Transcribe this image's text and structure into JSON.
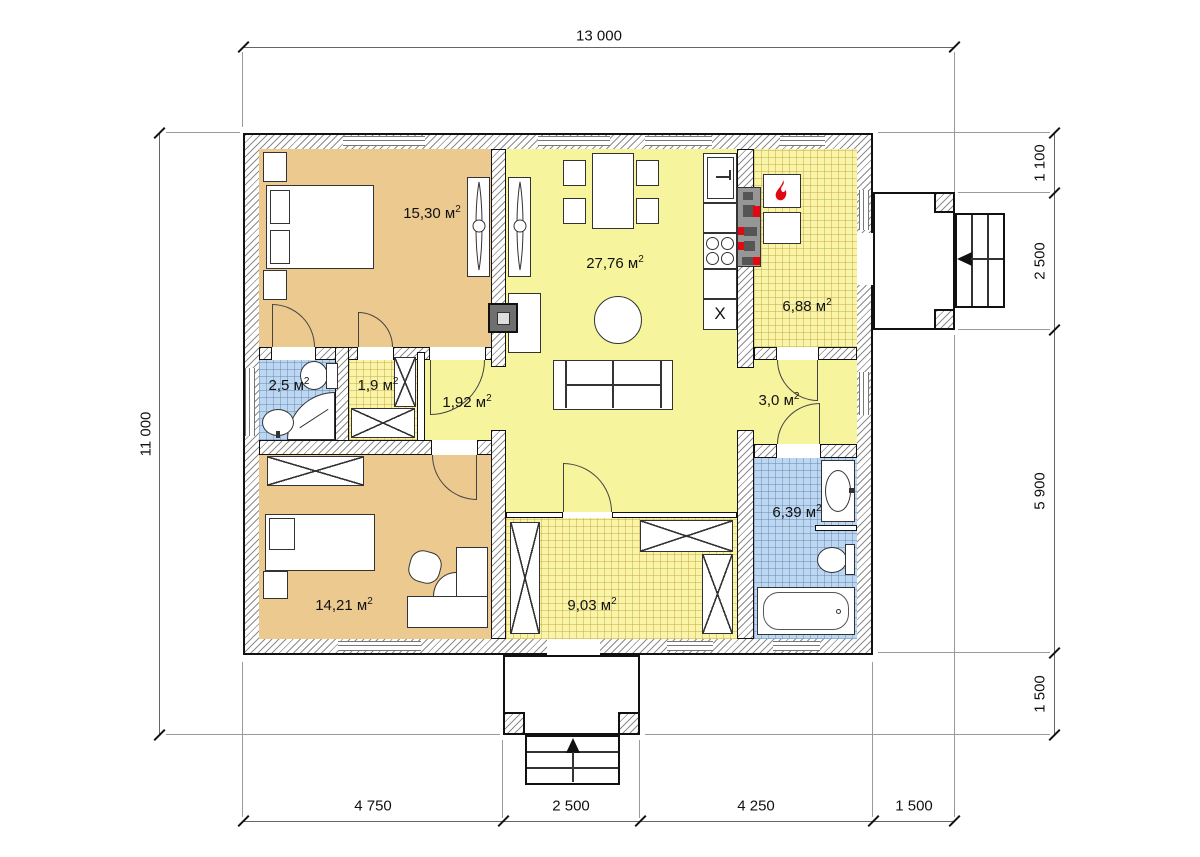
{
  "dimensions": {
    "top": "13 000",
    "left": "11 000",
    "right": [
      "1 100",
      "2 500",
      "5 900",
      "1 500"
    ],
    "bottom": [
      "4 750",
      "2 500",
      "4 250",
      "1 500"
    ]
  },
  "sup2": "2",
  "rooms": {
    "bedroom1": {
      "label": "15,30 м"
    },
    "living": {
      "label": "27,76 м"
    },
    "boiler": {
      "label": "6,88 м"
    },
    "bath_small": {
      "label": "2,5 м"
    },
    "closet": {
      "label": "1,9 м"
    },
    "hall_small": {
      "label": "1,92 м"
    },
    "hall_right": {
      "label": "3,0 м"
    },
    "bedroom2": {
      "label": "14,21 м"
    },
    "hall_entry": {
      "label": "9,03 м"
    },
    "bath_large": {
      "label": "6,39 м"
    }
  },
  "kitchen": {
    "x_marker": "X"
  },
  "colors": {
    "bedroom_fill": "#ecc98f",
    "hall_fill": "#f7f49e",
    "tile_yellow_fill": "#f8f5a8",
    "wet_fill": "#bcd7f1",
    "wall_line": "#111111",
    "accent_red": "#e30613",
    "equipment_gray": "#969696"
  }
}
